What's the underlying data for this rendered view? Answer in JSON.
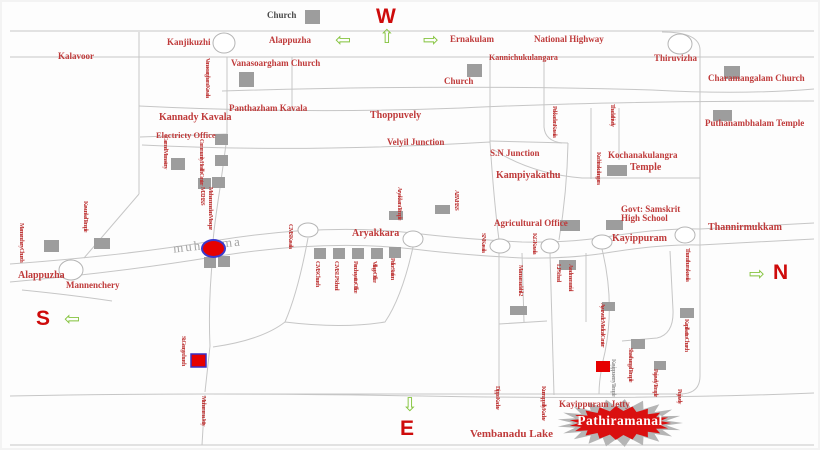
{
  "title": "Pathiramanal location map",
  "compass": {
    "w": "W",
    "s": "S",
    "n": "N",
    "e": "E"
  },
  "arrows": {
    "left": "⇦",
    "up": "⇧",
    "right": "⇨",
    "down": "⇩"
  },
  "colors": {
    "label_red": "#bf3a3a",
    "compass_red": "#ce0b0b",
    "arrow_green": "#86c440",
    "building_gray": "#9d9d9d",
    "road_gray": "#c6c6c6",
    "marker_red": "#e60000",
    "marker_border_blue": "#3a3acc",
    "starburst_gray": "#b5b5b5",
    "starburst_red": "#da0f0f",
    "muhamma_gray": "#a5a5a5"
  },
  "labels": {
    "church_top": "Church",
    "kanjikuzhi": "Kanjikuzhi",
    "alappuzha_top": "Alappuzha",
    "ernakulam": "Ernakulam",
    "national_highway": "National Highway",
    "kalavoor": "Kalavoor",
    "vanasoargham_church": "Vanasoargham Church",
    "kannichukulangara": "Kannichukulangara",
    "thiruvizha": "Thiruvizha",
    "church_mid": "Church",
    "charamangalam_church": "Charamangalam Church",
    "kannady_kavala": "Kannady Kavala",
    "panthazham_kavala": "Panthazham Kavala",
    "thoppuvely": "Thoppuvely",
    "electricity_office": "Electricty Office",
    "velyil_junction": "Velyil Junction",
    "sn_junction": "S.N Junction",
    "puthanambhalam_temple": "Puthanambhalam Temple",
    "kochanakulangra": "Kochanakulangra",
    "kochanakulangra_temple_word": "Temple",
    "kampiyakathu": "Kampiyakathu",
    "agricultural_office": "Agricultural Office",
    "govt_samskrit": "Govt: Samskrit High School",
    "thannirmukkam": "Thannirmukkam",
    "aryakkara": "Aryakkara",
    "kayippuram": "Kayippuram",
    "alappuzha_left": "Alappuzha",
    "mannenchery": "Mannenchery",
    "vembanadu_lake": "Vembanadu Lake",
    "kayippuram_jetty": "Kayippuram Jetty",
    "pathiramanal": "Pathiramanal",
    "muhamma": "muhamma",
    "vanasoargham_kavala": "Vanasoargham Kavala",
    "carmel_monastery": "Carmel Monastery",
    "community_health_center": "Community Health Center",
    "mohammedan_mosque": "Mohammedan Mosque M.T.H.S.S",
    "cms_kavala": "C.M.S Kavala",
    "cms_church": "C.M.S Church",
    "cms_lp_school": "C.M.S LP School",
    "panchayattu_office": "Panchayattu Office",
    "village_office": "Village Office",
    "police_station": "Police Station",
    "sn_kavala": "S.N Kavala",
    "kg_kavala": "K.G Kavala",
    "mannamadahil": "Mannamadahil-2",
    "azad_memorial": "Azad memorial",
    "lp_school": "L.P School",
    "ayurvedic": "Ayurvedic Medical Center",
    "kayippuserry_temple": "Kayippuserry Temple",
    "shasthangal_temple": "Shasthangal Temple",
    "pajavely_temple": "Pajavely Temple",
    "kapilkattu_church": "Kapilkattu Church",
    "pujavely": "Pujavely",
    "thuruthum_kavala": "Thuruthum kavala",
    "dippo_kadav": "Dippo Kadav",
    "kurruppolly_kadav": "Kurruppolly Kadav",
    "muhamma_jetty": "Muhamma Jetty",
    "st_george_church": "St. George church",
    "mannenchery_church": "Mannenchery Church",
    "kavunkal_temple": "Kavunkal Temple",
    "aryakkara_temple": "Aryakkara Temple",
    "abv_hss": "A.B.V.H.S.S",
    "pokkadan_kavala": "Pokkadan Kavala",
    "thadathively": "Thadathively",
    "kochinakulangara": "Kochinakulangara"
  }
}
